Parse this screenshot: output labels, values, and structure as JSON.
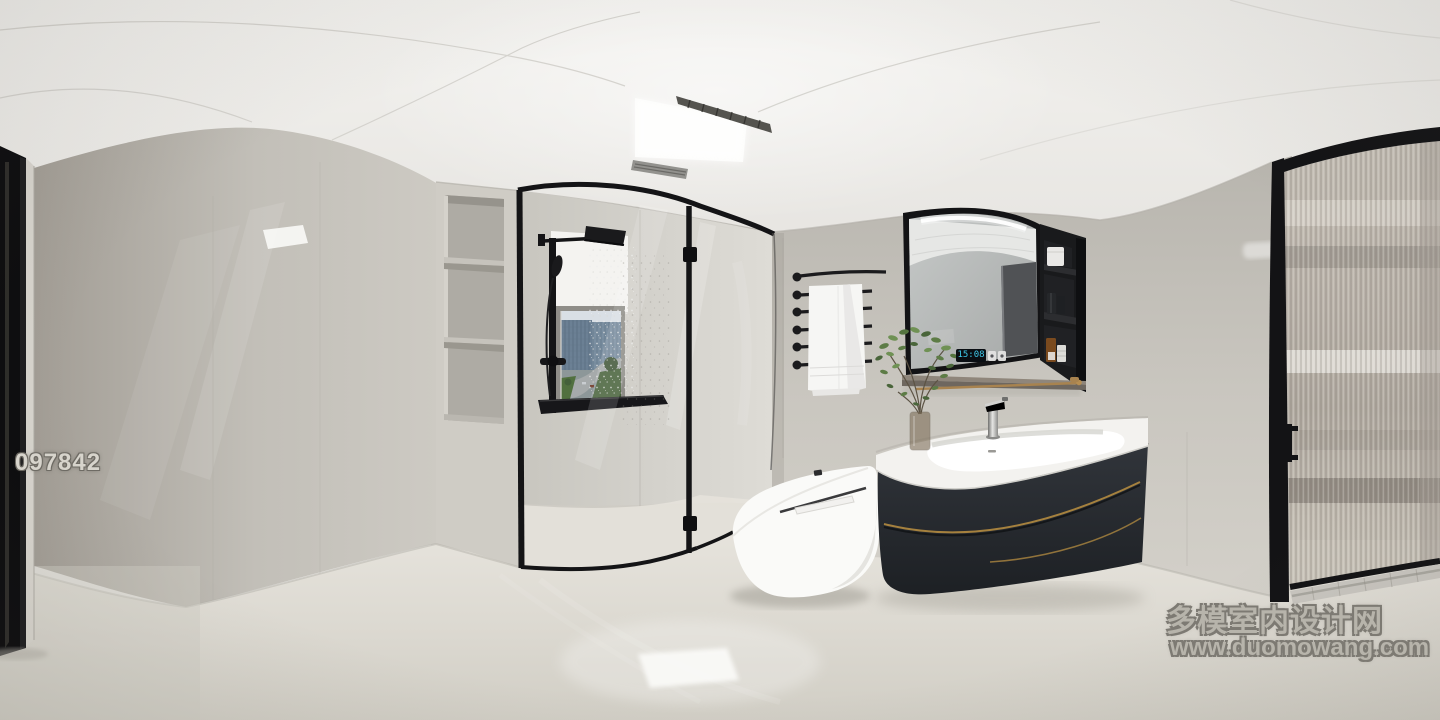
{
  "title": "360 panorama render - modern black and white bathroom",
  "watermarks": {
    "photo_id": "097842",
    "site_name": "多模室内设计网",
    "site_url": "www.duomowang.com"
  },
  "mirror_display": {
    "time": "15:08",
    "icons": [
      "light-toggle-icon",
      "defog-toggle-icon"
    ]
  },
  "palette": {
    "ceiling": "#f1f0ed",
    "walls": "#c6c3bc",
    "left_wall": "#ada99f",
    "floor": "#ddd9d1",
    "black_frames": "#141416",
    "vanity_cabinet": "#282c31",
    "gold_trim": "#a5813e",
    "brass_bar": "#a8834f",
    "mirror_glass": "#b4b7b6",
    "clock_blue": "#3fc8e9",
    "plant_green": "#5d7c46",
    "window_sky": "#d9dfe5",
    "window_buildings": "#6b8094",
    "towel_white": "#f6f6f4",
    "amber_bottle": "#7a4a1e"
  },
  "scene_objects": [
    "ceiling-light-panel",
    "ceiling-vent",
    "left-door-frame",
    "glossy-left-wall",
    "niche-shelves",
    "glass-shower-enclosure",
    "rain-shower",
    "window-city-view",
    "roller-shade",
    "black-ledge",
    "towel-rack",
    "white-towel",
    "smart-toilet",
    "vanity-cabinet",
    "basin-counter",
    "chrome-faucet",
    "mirror-cabinet",
    "side-open-shelf",
    "wood-shelf",
    "brass-towel-bar",
    "green-plant",
    "fluted-glass-door",
    "door-handle"
  ]
}
